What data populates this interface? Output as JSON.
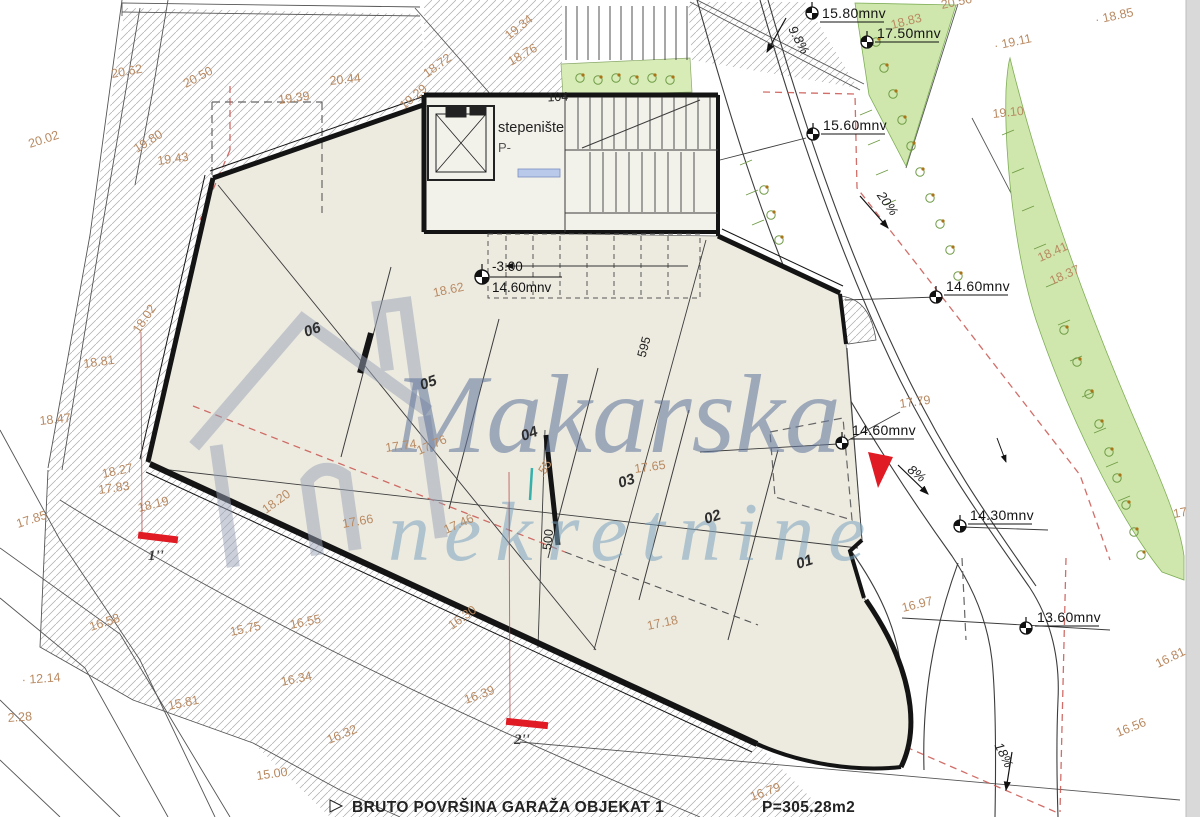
{
  "watermark": {
    "line1": "Makarska",
    "line2": "nekretnine"
  },
  "caption": {
    "text": "BRUTO POVRŠINA GARAŽA OBJEKAT 1",
    "area": "P=305.28m2"
  },
  "stairwell": {
    "line1": "stepenište",
    "line2": "P-"
  },
  "level_marker": {
    "relative": "-3.00",
    "absolute": "14.60mnv",
    "x": 482,
    "y": 277
  },
  "colors": {
    "accent_red": "#e01b24",
    "spot_label": "#b98a62",
    "green_fill": "#cfe7ac",
    "watermark_blue": "#64789e",
    "watermark_teal": "#7ba4bf"
  },
  "parking_stalls": [
    {
      "label": "06",
      "x": 306,
      "y": 337,
      "rot": -20
    },
    {
      "label": "05",
      "x": 422,
      "y": 390,
      "rot": -20
    },
    {
      "label": "04",
      "x": 523,
      "y": 441,
      "rot": -20
    },
    {
      "label": "03",
      "x": 620,
      "y": 488,
      "rot": -18
    },
    {
      "label": "02",
      "x": 706,
      "y": 524,
      "rot": -18
    },
    {
      "label": "01",
      "x": 798,
      "y": 569,
      "rot": -18
    }
  ],
  "benchmarks": [
    {
      "label": "15.80mnv",
      "sx": 812,
      "sy": 13,
      "tx": 822,
      "ty": 18
    },
    {
      "label": "17.50mnv",
      "sx": 867,
      "sy": 42,
      "tx": 877,
      "ty": 38
    },
    {
      "label": "15.60mnv",
      "sx": 813,
      "sy": 134,
      "tx": 823,
      "ty": 130
    },
    {
      "label": "14.60mnv",
      "sx": 936,
      "sy": 297,
      "tx": 946,
      "ty": 291
    },
    {
      "label": "14.60mnv",
      "sx": 842,
      "sy": 443,
      "tx": 852,
      "ty": 435
    },
    {
      "label": "14.30mnv",
      "sx": 960,
      "sy": 526,
      "tx": 970,
      "ty": 520
    },
    {
      "label": "13.60mnv",
      "sx": 1026,
      "sy": 628,
      "tx": 1037,
      "ty": 622
    }
  ],
  "spot_elevations": [
    {
      "t": "20.02",
      "x": 30,
      "y": 148,
      "r": -18
    },
    {
      "t": "20.62",
      "x": 112,
      "y": 78,
      "r": -10
    },
    {
      "t": "20.50",
      "x": 186,
      "y": 88,
      "r": -28
    },
    {
      "t": "20.44",
      "x": 330,
      "y": 85,
      "r": -6
    },
    {
      "t": "19.39",
      "x": 279,
      "y": 104,
      "r": -8
    },
    {
      "t": "19.80",
      "x": 137,
      "y": 153,
      "r": -32
    },
    {
      "t": "19.43",
      "x": 158,
      "y": 165,
      "r": -8
    },
    {
      "t": "19.34",
      "x": 509,
      "y": 40,
      "r": -38
    },
    {
      "t": "18.76",
      "x": 511,
      "y": 66,
      "r": -30
    },
    {
      "t": "18.72",
      "x": 427,
      "y": 78,
      "r": -36
    },
    {
      "t": "19.29",
      "x": 404,
      "y": 110,
      "r": -40
    },
    {
      "t": "18.62",
      "x": 434,
      "y": 297,
      "r": -12
    },
    {
      "t": "18.83",
      "x": 892,
      "y": 29,
      "r": -14
    },
    {
      "t": "20.56",
      "x": 942,
      "y": 9,
      "r": -12
    },
    {
      "t": "· 18.85",
      "x": 1096,
      "y": 24,
      "r": -12
    },
    {
      "t": "· 19.11",
      "x": 995,
      "y": 50,
      "r": -12
    },
    {
      "t": "19.10",
      "x": 993,
      "y": 118,
      "r": -6
    },
    {
      "t": "18.41",
      "x": 1040,
      "y": 262,
      "r": -24
    },
    {
      "t": "18.37",
      "x": 1052,
      "y": 285,
      "r": -24
    },
    {
      "t": "17.79",
      "x": 900,
      "y": 408,
      "r": -8
    },
    {
      "t": "17.74",
      "x": 386,
      "y": 452,
      "r": -8
    },
    {
      "t": "17.76",
      "x": 419,
      "y": 455,
      "r": -24
    },
    {
      "t": "17.66",
      "x": 343,
      "y": 528,
      "r": -10
    },
    {
      "t": "17.46",
      "x": 446,
      "y": 534,
      "r": -24
    },
    {
      "t": ".55",
      "x": 543,
      "y": 478,
      "r": -58
    },
    {
      "t": "17.65",
      "x": 635,
      "y": 473,
      "r": -8
    },
    {
      "t": "17.18",
      "x": 648,
      "y": 630,
      "r": -12
    },
    {
      "t": "16.39",
      "x": 466,
      "y": 704,
      "r": -20
    },
    {
      "t": "16.30",
      "x": 452,
      "y": 630,
      "r": -36
    },
    {
      "t": "18.20",
      "x": 266,
      "y": 514,
      "r": -36
    },
    {
      "t": "18.19",
      "x": 139,
      "y": 512,
      "r": -14
    },
    {
      "t": "18.27",
      "x": 103,
      "y": 478,
      "r": -12
    },
    {
      "t": "17.83",
      "x": 99,
      "y": 494,
      "r": -8
    },
    {
      "t": "18.81",
      "x": 84,
      "y": 368,
      "r": -8
    },
    {
      "t": "18.47",
      "x": 40,
      "y": 425,
      "r": -6
    },
    {
      "t": "18.02",
      "x": 139,
      "y": 334,
      "r": -56
    },
    {
      "t": "17.85",
      "x": 18,
      "y": 528,
      "r": -18
    },
    {
      "t": "16.58",
      "x": 91,
      "y": 631,
      "r": -18
    },
    {
      "t": "15.75",
      "x": 231,
      "y": 636,
      "r": -12
    },
    {
      "t": "16.55",
      "x": 291,
      "y": 629,
      "r": -12
    },
    {
      "t": "16.34",
      "x": 282,
      "y": 686,
      "r": -12
    },
    {
      "t": "15.81",
      "x": 169,
      "y": 710,
      "r": -12
    },
    {
      "t": "16.32",
      "x": 329,
      "y": 744,
      "r": -22
    },
    {
      "t": "15.00",
      "x": 257,
      "y": 780,
      "r": -8
    },
    {
      "t": "· 12.14",
      "x": 22,
      "y": 684,
      "r": -4
    },
    {
      "t": "2.28",
      "x": 8,
      "y": 722,
      "r": -4
    },
    {
      "t": "16.97",
      "x": 903,
      "y": 612,
      "r": -14
    },
    {
      "t": "16.81",
      "x": 1158,
      "y": 668,
      "r": -26
    },
    {
      "t": "16.56",
      "x": 1118,
      "y": 737,
      "r": -22
    },
    {
      "t": "16.79",
      "x": 752,
      "y": 801,
      "r": -20
    },
    {
      "t": "17.",
      "x": 1174,
      "y": 518,
      "r": -10
    }
  ],
  "slope_arrows": [
    {
      "label": "9.8%",
      "x": 795,
      "y": 42,
      "rot": 62,
      "arrow": [
        786,
        18,
        767,
        52
      ]
    },
    {
      "label": "20%",
      "x": 884,
      "y": 206,
      "rot": 55,
      "arrow": [
        860,
        196,
        888,
        228
      ]
    },
    {
      "label": "8%",
      "x": 914,
      "y": 477,
      "rot": 38,
      "arrow": [
        898,
        465,
        928,
        494
      ]
    },
    {
      "label": "18%",
      "x": 1000,
      "y": 757,
      "rot": 64,
      "arrow": [
        1012,
        752,
        1006,
        790
      ]
    }
  ],
  "dimensions": [
    {
      "label": "104",
      "x": 558,
      "y": 101,
      "rot": -3
    },
    {
      "label": "595",
      "x": 648,
      "y": 348,
      "rot": -75
    },
    {
      "label": "500",
      "x": 552,
      "y": 540,
      "rot": -84
    }
  ],
  "section_marks": [
    {
      "label": "1''",
      "bar": {
        "x": 138,
        "y": 534,
        "w": 40,
        "h": 7,
        "rot": 7
      },
      "line": {
        "x1": 141,
        "y1": 332,
        "x2": 142,
        "y2": 534
      },
      "lx": 148,
      "ly": 560
    },
    {
      "label": "2''",
      "bar": {
        "x": 506,
        "y": 720,
        "w": 42,
        "h": 7,
        "rot": 6
      },
      "line": {
        "x1": 509,
        "y1": 472,
        "x2": 510,
        "y2": 720
      },
      "lx": 514,
      "ly": 744
    }
  ],
  "plant_symbols": [
    [
      580,
      78
    ],
    [
      598,
      80
    ],
    [
      616,
      78
    ],
    [
      634,
      80
    ],
    [
      652,
      78
    ],
    [
      670,
      80
    ],
    [
      876,
      42
    ],
    [
      884,
      68
    ],
    [
      893,
      94
    ],
    [
      902,
      120
    ],
    [
      911,
      146
    ],
    [
      920,
      172
    ],
    [
      930,
      198
    ],
    [
      940,
      224
    ],
    [
      950,
      250
    ],
    [
      958,
      276
    ],
    [
      764,
      190
    ],
    [
      771,
      215
    ],
    [
      779,
      240
    ],
    [
      1064,
      330
    ],
    [
      1077,
      362
    ],
    [
      1089,
      394
    ],
    [
      1099,
      424
    ],
    [
      1109,
      452
    ],
    [
      1117,
      478
    ],
    [
      1126,
      505
    ],
    [
      1134,
      532
    ],
    [
      1141,
      555
    ]
  ]
}
